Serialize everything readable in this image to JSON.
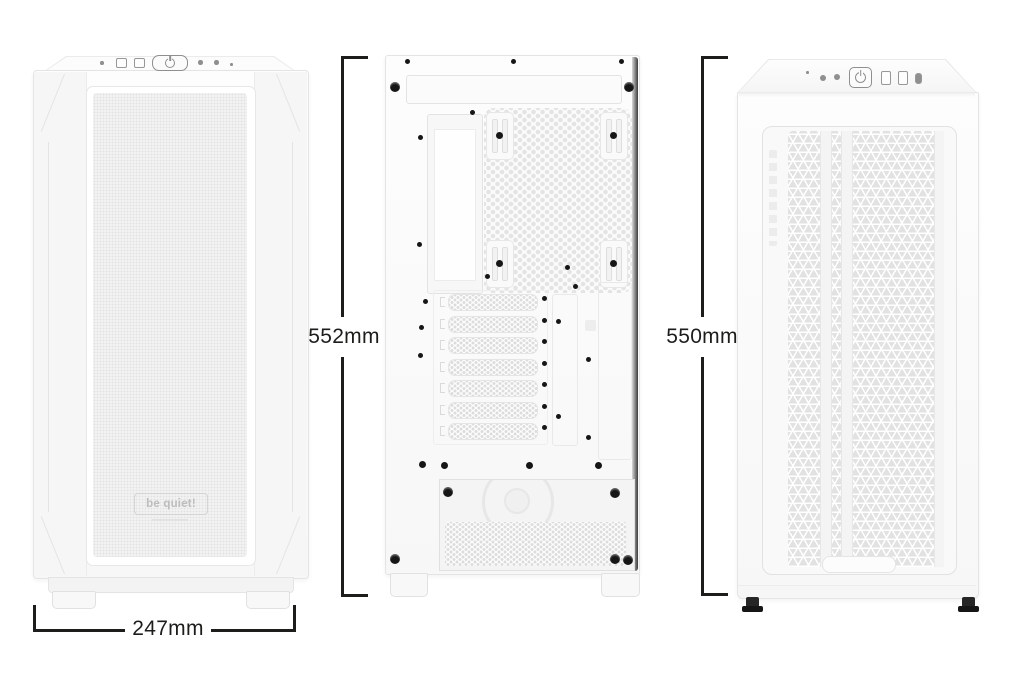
{
  "scene": {
    "type": "product-dimension-diagram",
    "background": "#ffffff",
    "subject": "Three white PC tower case views with measurement callouts"
  },
  "measurements": {
    "front_width": {
      "label": "247mm",
      "orientation": "horizontal"
    },
    "rear_height": {
      "label": "552mm",
      "orientation": "vertical"
    },
    "front_height": {
      "label": "550mm",
      "orientation": "vertical"
    }
  },
  "left_case": {
    "view": "front",
    "brand_logo": "be quiet!",
    "io_panel": [
      "audio-jack",
      "usb-a-port",
      "usb-a-port",
      "power-button",
      "led-button",
      "fan-button",
      "reset-pinhole"
    ]
  },
  "middle_case": {
    "view": "rear",
    "features": [
      "top-vent",
      "motherboard-io-cutout",
      "rear-fan-honeycomb-mesh",
      "seven-expansion-slot-covers",
      "psu-bay-with-fan",
      "thumbscrews",
      "case-feet"
    ]
  },
  "right_case": {
    "view": "front",
    "io_panel": [
      "reset-pinhole",
      "mic-jack",
      "headphone-jack",
      "power-button",
      "usb-a-port",
      "usb-a-port",
      "usb-c-port"
    ],
    "features": [
      "triangular-mesh-front-panel",
      "bottom-handle-indent",
      "rubber-feet"
    ]
  },
  "colors": {
    "dimension_line": "#1d1d1b",
    "case_fill": "#fafafa",
    "case_edge": "#e3e3e3",
    "mesh_tone": "#e2e2e2",
    "screw": "#161616"
  }
}
